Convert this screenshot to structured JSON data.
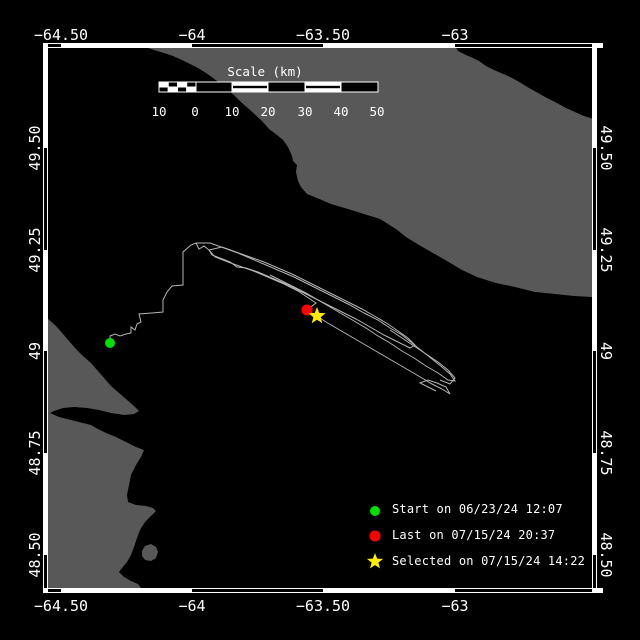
{
  "colors": {
    "background": "#000000",
    "land": "#585858",
    "water": "#000000",
    "frame": "#ffffff",
    "text": "#ffffff",
    "track": "#b4b4b4",
    "start_green": "#00e000",
    "last_red": "#ff0000",
    "selected_yellow": "#ffee00"
  },
  "axes": {
    "top_ticks": [
      {
        "label": "−64.50",
        "x": 61
      },
      {
        "label": "−64",
        "x": 192
      },
      {
        "label": "−63.50",
        "x": 323
      },
      {
        "label": "−63",
        "x": 455
      }
    ],
    "bottom_ticks": [
      {
        "label": "−64.50",
        "x": 61
      },
      {
        "label": "−64",
        "x": 192
      },
      {
        "label": "−63.50",
        "x": 323
      },
      {
        "label": "−63",
        "x": 455
      }
    ],
    "left_ticks": [
      {
        "label": "49.50",
        "y": 148
      },
      {
        "label": "49.25",
        "y": 250
      },
      {
        "label": "49",
        "y": 351
      },
      {
        "label": "48.75",
        "y": 453
      },
      {
        "label": "48.50",
        "y": 555
      }
    ],
    "right_ticks": [
      {
        "label": "49.50",
        "y": 148
      },
      {
        "label": "49.25",
        "y": 250
      },
      {
        "label": "49",
        "y": 351
      },
      {
        "label": "48.75",
        "y": 453
      },
      {
        "label": "48.50",
        "y": 555
      }
    ]
  },
  "scale_bar": {
    "title": "Scale (km)",
    "title_x": 265,
    "title_y": 64,
    "labels": [
      {
        "text": "10",
        "x": 159
      },
      {
        "text": "0",
        "x": 195
      },
      {
        "text": "10",
        "x": 232
      },
      {
        "text": "20",
        "x": 268
      },
      {
        "text": "30",
        "x": 305
      },
      {
        "text": "40",
        "x": 341
      },
      {
        "text": "50",
        "x": 377
      }
    ],
    "labels_y": 104,
    "bar": {
      "x": 159,
      "y": 82,
      "h": 10,
      "sub_x": 159,
      "sub_w": 37,
      "sub_cells": 4,
      "boxes": [
        {
          "x": 196,
          "w": 36,
          "fill": "solid"
        },
        {
          "x": 232,
          "w": 36,
          "fill": "striped"
        },
        {
          "x": 268,
          "w": 37,
          "fill": "solid"
        },
        {
          "x": 305,
          "w": 36,
          "fill": "striped"
        },
        {
          "x": 341,
          "w": 37,
          "fill": "solid"
        }
      ]
    }
  },
  "legend": {
    "items": [
      {
        "marker": "circle",
        "color": "#00e000",
        "label": "Start on 06/23/24 12:07"
      },
      {
        "marker": "circle",
        "color": "#ff0000",
        "label": "Last on 07/15/24 20:37"
      },
      {
        "marker": "star",
        "color": "#ffee00",
        "label": "Selected on 07/15/24 14:22"
      }
    ]
  },
  "markers": {
    "start": {
      "x": 110,
      "y": 343,
      "r": 5,
      "color": "#00e000"
    },
    "last": {
      "x": 307,
      "y": 310,
      "r": 5.5,
      "color": "#ff0000"
    },
    "selected": {
      "x": 317,
      "y": 316,
      "ro": 9,
      "ri": 3.8,
      "color": "#ffee00"
    }
  },
  "map": {
    "frame": {
      "left": 48,
      "right": 592,
      "top": 48,
      "bottom": 588,
      "band": 5,
      "zebra_top_start_black": true,
      "zebra_left_start_black": false
    },
    "land_polygons": [
      {
        "name": "land-anticosti",
        "points": [
          [
            137,
            46
          ],
          [
            455,
            46
          ],
          [
            458,
            51
          ],
          [
            466,
            55
          ],
          [
            473,
            58
          ],
          [
            479,
            61
          ],
          [
            486,
            66
          ],
          [
            494,
            70
          ],
          [
            501,
            73
          ],
          [
            508,
            76
          ],
          [
            514,
            79
          ],
          [
            521,
            83
          ],
          [
            529,
            88
          ],
          [
            538,
            93
          ],
          [
            547,
            98
          ],
          [
            557,
            103
          ],
          [
            566,
            108
          ],
          [
            575,
            112
          ],
          [
            584,
            116
          ],
          [
            593,
            119
          ],
          [
            593,
            297
          ],
          [
            574,
            296
          ],
          [
            555,
            294
          ],
          [
            535,
            292
          ],
          [
            515,
            287
          ],
          [
            496,
            283
          ],
          [
            477,
            277
          ],
          [
            462,
            270
          ],
          [
            447,
            261
          ],
          [
            433,
            253
          ],
          [
            419,
            245
          ],
          [
            406,
            237
          ],
          [
            396,
            229
          ],
          [
            388,
            224
          ],
          [
            380,
            219
          ],
          [
            364,
            214
          ],
          [
            348,
            209
          ],
          [
            331,
            204
          ],
          [
            317,
            198
          ],
          [
            307,
            194
          ],
          [
            301,
            187
          ],
          [
            298,
            181
          ],
          [
            296,
            172
          ],
          [
            297,
            165
          ],
          [
            293,
            161
          ],
          [
            292,
            156
          ],
          [
            288,
            147
          ],
          [
            283,
            140
          ],
          [
            277,
            135
          ],
          [
            269,
            129
          ],
          [
            262,
            121
          ],
          [
            249,
            109
          ],
          [
            242,
            103
          ],
          [
            235,
            96
          ],
          [
            229,
            91
          ],
          [
            221,
            84
          ],
          [
            213,
            78
          ],
          [
            206,
            73
          ],
          [
            198,
            68
          ],
          [
            190,
            64
          ],
          [
            182,
            60
          ],
          [
            173,
            56
          ],
          [
            164,
            53
          ],
          [
            154,
            50
          ],
          [
            145,
            47
          ]
        ]
      },
      {
        "name": "land-gaspe",
        "points": [
          [
            47,
            318
          ],
          [
            56,
            326
          ],
          [
            63,
            334
          ],
          [
            69,
            341
          ],
          [
            76,
            349
          ],
          [
            83,
            356
          ],
          [
            91,
            363
          ],
          [
            98,
            371
          ],
          [
            105,
            379
          ],
          [
            111,
            386
          ],
          [
            119,
            393
          ],
          [
            126,
            399
          ],
          [
            134,
            406
          ],
          [
            139,
            411
          ],
          [
            134,
            414
          ],
          [
            124,
            415
          ],
          [
            111,
            413
          ],
          [
            99,
            410
          ],
          [
            87,
            408
          ],
          [
            74,
            407
          ],
          [
            63,
            408
          ],
          [
            54,
            411
          ],
          [
            50,
            413
          ],
          [
            59,
            417
          ],
          [
            71,
            420
          ],
          [
            83,
            423
          ],
          [
            91,
            425
          ],
          [
            96,
            428
          ],
          [
            106,
            433
          ],
          [
            116,
            437
          ],
          [
            126,
            442
          ],
          [
            136,
            447
          ],
          [
            144,
            450
          ],
          [
            141,
            457
          ],
          [
            136,
            465
          ],
          [
            131,
            475
          ],
          [
            129,
            485
          ],
          [
            127,
            495
          ],
          [
            128,
            502
          ],
          [
            136,
            505
          ],
          [
            146,
            506
          ],
          [
            153,
            508
          ],
          [
            156,
            511
          ],
          [
            151,
            516
          ],
          [
            145,
            522
          ],
          [
            140,
            530
          ],
          [
            137,
            538
          ],
          [
            134,
            547
          ],
          [
            131,
            555
          ],
          [
            127,
            562
          ],
          [
            122,
            568
          ],
          [
            119,
            572
          ],
          [
            124,
            577
          ],
          [
            131,
            581
          ],
          [
            138,
            584
          ],
          [
            141,
            588
          ],
          [
            142,
            594
          ],
          [
            47,
            594
          ]
        ]
      },
      {
        "name": "land-small-island",
        "points": [
          [
            142,
            551
          ],
          [
            145,
            546
          ],
          [
            151,
            544
          ],
          [
            156,
            547
          ],
          [
            158,
            552
          ],
          [
            156,
            558
          ],
          [
            151,
            561
          ],
          [
            145,
            560
          ],
          [
            142,
            556
          ]
        ]
      }
    ]
  },
  "track": {
    "strands": [
      [
        [
          110,
          341
        ],
        [
          110,
          336
        ],
        [
          115,
          334
        ],
        [
          120,
          336
        ],
        [
          126,
          334
        ],
        [
          131,
          333
        ],
        [
          131,
          327
        ],
        [
          135,
          330
        ],
        [
          137,
          324
        ],
        [
          141,
          322
        ],
        [
          139,
          314
        ],
        [
          152,
          313
        ],
        [
          163,
          312
        ],
        [
          163,
          300
        ],
        [
          167,
          292
        ],
        [
          172,
          286
        ],
        [
          183,
          285
        ],
        [
          183,
          268
        ],
        [
          183,
          252
        ],
        [
          191,
          245
        ],
        [
          196,
          243
        ],
        [
          199,
          249
        ],
        [
          204,
          246
        ],
        [
          209,
          250
        ]
      ],
      [
        [
          209,
          250
        ],
        [
          222,
          247
        ],
        [
          236,
          252
        ],
        [
          250,
          257
        ],
        [
          264,
          262
        ],
        [
          278,
          268
        ],
        [
          292,
          274
        ],
        [
          306,
          281
        ],
        [
          320,
          288
        ],
        [
          334,
          295
        ],
        [
          348,
          302
        ],
        [
          362,
          309
        ],
        [
          376,
          317
        ],
        [
          388,
          324
        ],
        [
          398,
          331
        ],
        [
          408,
          338
        ],
        [
          415,
          345
        ],
        [
          410,
          348
        ],
        [
          398,
          342
        ],
        [
          384,
          335
        ],
        [
          370,
          327
        ],
        [
          356,
          319
        ],
        [
          342,
          312
        ],
        [
          328,
          305
        ],
        [
          314,
          298
        ],
        [
          300,
          291
        ],
        [
          286,
          284
        ],
        [
          272,
          278
        ],
        [
          258,
          272
        ],
        [
          246,
          268
        ],
        [
          237,
          267
        ],
        [
          230,
          262
        ],
        [
          220,
          258
        ],
        [
          212,
          255
        ],
        [
          209,
          250
        ]
      ],
      [
        [
          196,
          243
        ],
        [
          210,
          243
        ],
        [
          224,
          248
        ],
        [
          238,
          253
        ],
        [
          252,
          259
        ],
        [
          266,
          265
        ],
        [
          280,
          271
        ],
        [
          294,
          277
        ],
        [
          308,
          284
        ],
        [
          322,
          291
        ],
        [
          336,
          298
        ],
        [
          350,
          305
        ],
        [
          364,
          313
        ],
        [
          378,
          320
        ],
        [
          390,
          328
        ],
        [
          402,
          335
        ],
        [
          412,
          343
        ],
        [
          422,
          351
        ],
        [
          432,
          359
        ],
        [
          442,
          367
        ],
        [
          450,
          374
        ],
        [
          455,
          381
        ],
        [
          448,
          380
        ],
        [
          438,
          373
        ],
        [
          426,
          366
        ],
        [
          414,
          358
        ],
        [
          402,
          351
        ],
        [
          390,
          343
        ],
        [
          378,
          336
        ],
        [
          366,
          328
        ],
        [
          354,
          321
        ],
        [
          342,
          314
        ],
        [
          330,
          307
        ],
        [
          318,
          300
        ],
        [
          306,
          293
        ],
        [
          294,
          287
        ],
        [
          282,
          281
        ],
        [
          270,
          275
        ]
      ],
      [
        [
          209,
          250
        ],
        [
          215,
          257
        ],
        [
          228,
          262
        ],
        [
          242,
          267
        ],
        [
          256,
          272
        ],
        [
          270,
          278
        ],
        [
          284,
          284
        ],
        [
          298,
          291
        ],
        [
          307,
          297
        ],
        [
          316,
          303
        ],
        [
          307,
          310
        ],
        [
          317,
          316
        ],
        [
          326,
          322
        ],
        [
          338,
          329
        ],
        [
          350,
          336
        ],
        [
          362,
          343
        ],
        [
          374,
          350
        ],
        [
          386,
          357
        ],
        [
          398,
          364
        ],
        [
          410,
          371
        ],
        [
          422,
          378
        ],
        [
          432,
          384
        ],
        [
          442,
          389
        ],
        [
          450,
          394
        ],
        [
          446,
          387
        ],
        [
          437,
          383
        ],
        [
          428,
          380
        ],
        [
          420,
          383
        ],
        [
          428,
          387
        ],
        [
          436,
          391
        ]
      ],
      [
        [
          390,
          330
        ],
        [
          402,
          338
        ],
        [
          414,
          346
        ],
        [
          426,
          354
        ],
        [
          438,
          362
        ],
        [
          448,
          370
        ],
        [
          455,
          378
        ],
        [
          450,
          384
        ],
        [
          440,
          380
        ]
      ]
    ]
  }
}
